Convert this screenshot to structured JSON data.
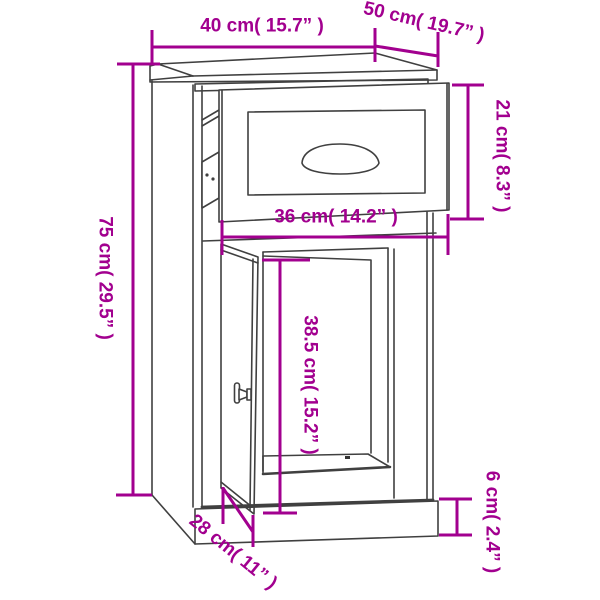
{
  "figure": {
    "type": "furniture-dimension-diagram",
    "subject": "side cabinet with pulled-out drawer and open door"
  },
  "colors": {
    "dimension_accent": "#A2008F",
    "outline": "#404040",
    "background": "#FFFFFF"
  },
  "dims": {
    "d40": {
      "id": "overall-width",
      "label": "40 cm( 15.7” )",
      "value_cm": 40,
      "value_in": 15.7,
      "orientation": "horizontal"
    },
    "d50": {
      "id": "overall-depth",
      "label": "50 cm( 19.7” )",
      "value_cm": 50,
      "value_in": 19.7,
      "orientation": "diagonal"
    },
    "d21": {
      "id": "drawer-height",
      "label": "21 cm( 8.3” )",
      "value_cm": 21,
      "value_in": 8.3,
      "orientation": "vertical"
    },
    "d75": {
      "id": "overall-height",
      "label": "75 cm( 29.5” )",
      "value_cm": 75,
      "value_in": 29.5,
      "orientation": "vertical"
    },
    "d36": {
      "id": "drawer-width",
      "label": "36 cm( 14.2” )",
      "value_cm": 36,
      "value_in": 14.2,
      "orientation": "horizontal"
    },
    "d385": {
      "id": "door-opening-height",
      "label": "38.5 cm( 15.2” )",
      "value_cm": 38.5,
      "value_in": 15.2,
      "orientation": "vertical"
    },
    "d6": {
      "id": "plinth-height",
      "label": "6 cm( 2.4” )",
      "value_cm": 6,
      "value_in": 2.4,
      "orientation": "vertical"
    },
    "d28": {
      "id": "base-depth",
      "label": "28 cm( 11” )",
      "value_cm": 28,
      "value_in": 11,
      "orientation": "diagonal"
    }
  }
}
